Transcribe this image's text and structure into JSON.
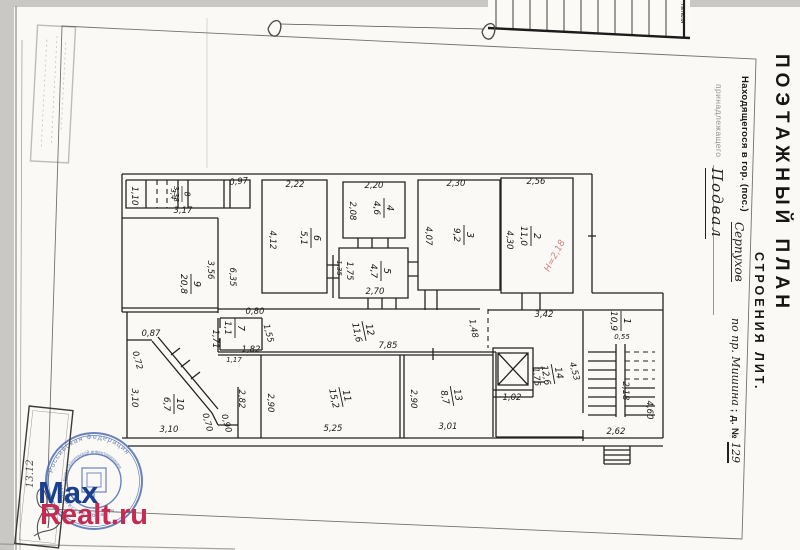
{
  "document": {
    "title": "ПОЭТАЖНЫЙ ПЛАН",
    "subtitle": "СТРОЕНИЯ ЛИТ.",
    "location_label": "Находящегося в гор. (пос.)",
    "location_value": "Серпухов",
    "address_value": "по пр. Мишина",
    "house_label": " ; д. №",
    "house_value": "129",
    "owner_label": "принадлежащего",
    "floor_label": "Подвал"
  },
  "edge_strip": {
    "cell_text": "гателя"
  },
  "stamp": {
    "ring_top": "Российская Федерация",
    "ring_bottom": "Московская область",
    "inner_ring": "Бюро технической инвентаризации",
    "color": "#4565ae"
  },
  "signature": {
    "date": "13.12"
  },
  "watermark": {
    "line1": "Max",
    "line2": "Realt.ru",
    "color1": "#1b3f8f",
    "color2": "#c42a52"
  },
  "plan": {
    "height_stamp": "Н=2,18",
    "rooms": [
      {
        "num": "1",
        "area": "10,9",
        "x": 621,
        "y": 321,
        "r": 90
      },
      {
        "num": "2",
        "area": "11,0",
        "x": 531,
        "y": 236,
        "r": 90
      },
      {
        "num": "3",
        "area": "9,2",
        "x": 464,
        "y": 235,
        "r": 90
      },
      {
        "num": "4",
        "area": "4,6",
        "x": 384,
        "y": 208,
        "r": 90
      },
      {
        "num": "5",
        "area": "4,7",
        "x": 381,
        "y": 271,
        "r": 90
      },
      {
        "num": "6",
        "area": "5,1",
        "x": 311,
        "y": 238,
        "r": 90
      },
      {
        "num": "7",
        "area": "1,1",
        "x": 235,
        "y": 328,
        "r": 90
      },
      {
        "num": "8",
        "area": "3,38",
        "x": 182,
        "y": 194,
        "r": 90,
        "sm": true
      },
      {
        "num": "9",
        "area": "20,8",
        "x": 191,
        "y": 284,
        "r": 90
      },
      {
        "num": "10",
        "area": "6,7",
        "x": 174,
        "y": 404,
        "r": 90
      },
      {
        "num": "11",
        "area": "15,2",
        "x": 341,
        "y": 397,
        "r": 78
      },
      {
        "num": "12",
        "area": "11,6",
        "x": 364,
        "y": 331,
        "r": 78
      },
      {
        "num": "13",
        "area": "8,7",
        "x": 452,
        "y": 396,
        "r": 80
      },
      {
        "num": "14",
        "area": "12,6",
        "x": 553,
        "y": 374,
        "r": 80
      }
    ],
    "dims": [
      {
        "t": "1,10",
        "x": 132,
        "y": 196,
        "r": 90
      },
      {
        "t": "3,4",
        "x": 171,
        "y": 194,
        "r": 90,
        "cls": "sm"
      },
      {
        "t": "0,97",
        "x": 239,
        "y": 184,
        "r": -6
      },
      {
        "t": "3,17",
        "x": 183,
        "y": 213,
        "r": 0
      },
      {
        "t": "3,56",
        "x": 208,
        "y": 270,
        "r": 90
      },
      {
        "t": "6,35",
        "x": 230,
        "y": 277,
        "r": 90
      },
      {
        "t": "2,22",
        "x": 295,
        "y": 187,
        "r": 0
      },
      {
        "t": "4,12",
        "x": 270,
        "y": 240,
        "r": 90
      },
      {
        "t": "2,20",
        "x": 374,
        "y": 188,
        "r": 0
      },
      {
        "t": "2,08",
        "x": 350,
        "y": 211,
        "r": 90
      },
      {
        "t": "1,35",
        "x": 337,
        "y": 268,
        "r": 90,
        "cls": "sm"
      },
      {
        "t": "1,75",
        "x": 347,
        "y": 271,
        "r": 90
      },
      {
        "t": "2,70",
        "x": 375,
        "y": 294,
        "r": 0
      },
      {
        "t": "2,30",
        "x": 456,
        "y": 186,
        "r": 0
      },
      {
        "t": "4,07",
        "x": 426,
        "y": 236,
        "r": 90
      },
      {
        "t": "2,56",
        "x": 536,
        "y": 184,
        "r": 0
      },
      {
        "t": "4,30",
        "x": 507,
        "y": 240,
        "r": 90
      },
      {
        "t": "0,80",
        "x": 255,
        "y": 314,
        "r": 0
      },
      {
        "t": "1,55",
        "x": 266,
        "y": 334,
        "r": 75
      },
      {
        "t": "1,82",
        "x": 251,
        "y": 352,
        "r": 0
      },
      {
        "t": "1,71",
        "x": 213,
        "y": 339,
        "r": 90
      },
      {
        "t": "1,17",
        "x": 234,
        "y": 362,
        "r": 0,
        "cls": "sm"
      },
      {
        "t": "7,85",
        "x": 388,
        "y": 348,
        "r": 0
      },
      {
        "t": "1,48",
        "x": 471,
        "y": 329,
        "r": 80
      },
      {
        "t": "3,42",
        "x": 544,
        "y": 317,
        "r": 0
      },
      {
        "t": "1,75",
        "x": 534,
        "y": 377,
        "r": 85
      },
      {
        "t": "1,02",
        "x": 512,
        "y": 400,
        "r": 0
      },
      {
        "t": "4,53",
        "x": 572,
        "y": 372,
        "r": 75
      },
      {
        "t": "0,55",
        "x": 622,
        "y": 339,
        "r": 0,
        "cls": "sm"
      },
      {
        "t": "2,18",
        "x": 623,
        "y": 391,
        "r": 90
      },
      {
        "t": "4,60",
        "x": 647,
        "y": 410,
        "r": 90
      },
      {
        "t": "2,62",
        "x": 616,
        "y": 434,
        "r": 0
      },
      {
        "t": "0,87",
        "x": 151,
        "y": 336,
        "r": 0
      },
      {
        "t": "0,72",
        "x": 135,
        "y": 361,
        "r": 75
      },
      {
        "t": "3,10",
        "x": 132,
        "y": 398,
        "r": 90
      },
      {
        "t": "3,10",
        "x": 169,
        "y": 432,
        "r": 0
      },
      {
        "t": "0,70",
        "x": 205,
        "y": 423,
        "r": 75
      },
      {
        "t": "0,90",
        "x": 224,
        "y": 424,
        "r": 75
      },
      {
        "t": "2,82",
        "x": 239,
        "y": 399,
        "r": 90
      },
      {
        "t": "2,90",
        "x": 268,
        "y": 403,
        "r": 90
      },
      {
        "t": "5,25",
        "x": 333,
        "y": 431,
        "r": 0
      },
      {
        "t": "2,90",
        "x": 411,
        "y": 399,
        "r": 90
      },
      {
        "t": "3,01",
        "x": 448,
        "y": 429,
        "r": 0
      },
      {
        "t": "Н=2,18",
        "x": 557,
        "y": 257,
        "r": -62,
        "cls": "pink"
      }
    ]
  }
}
